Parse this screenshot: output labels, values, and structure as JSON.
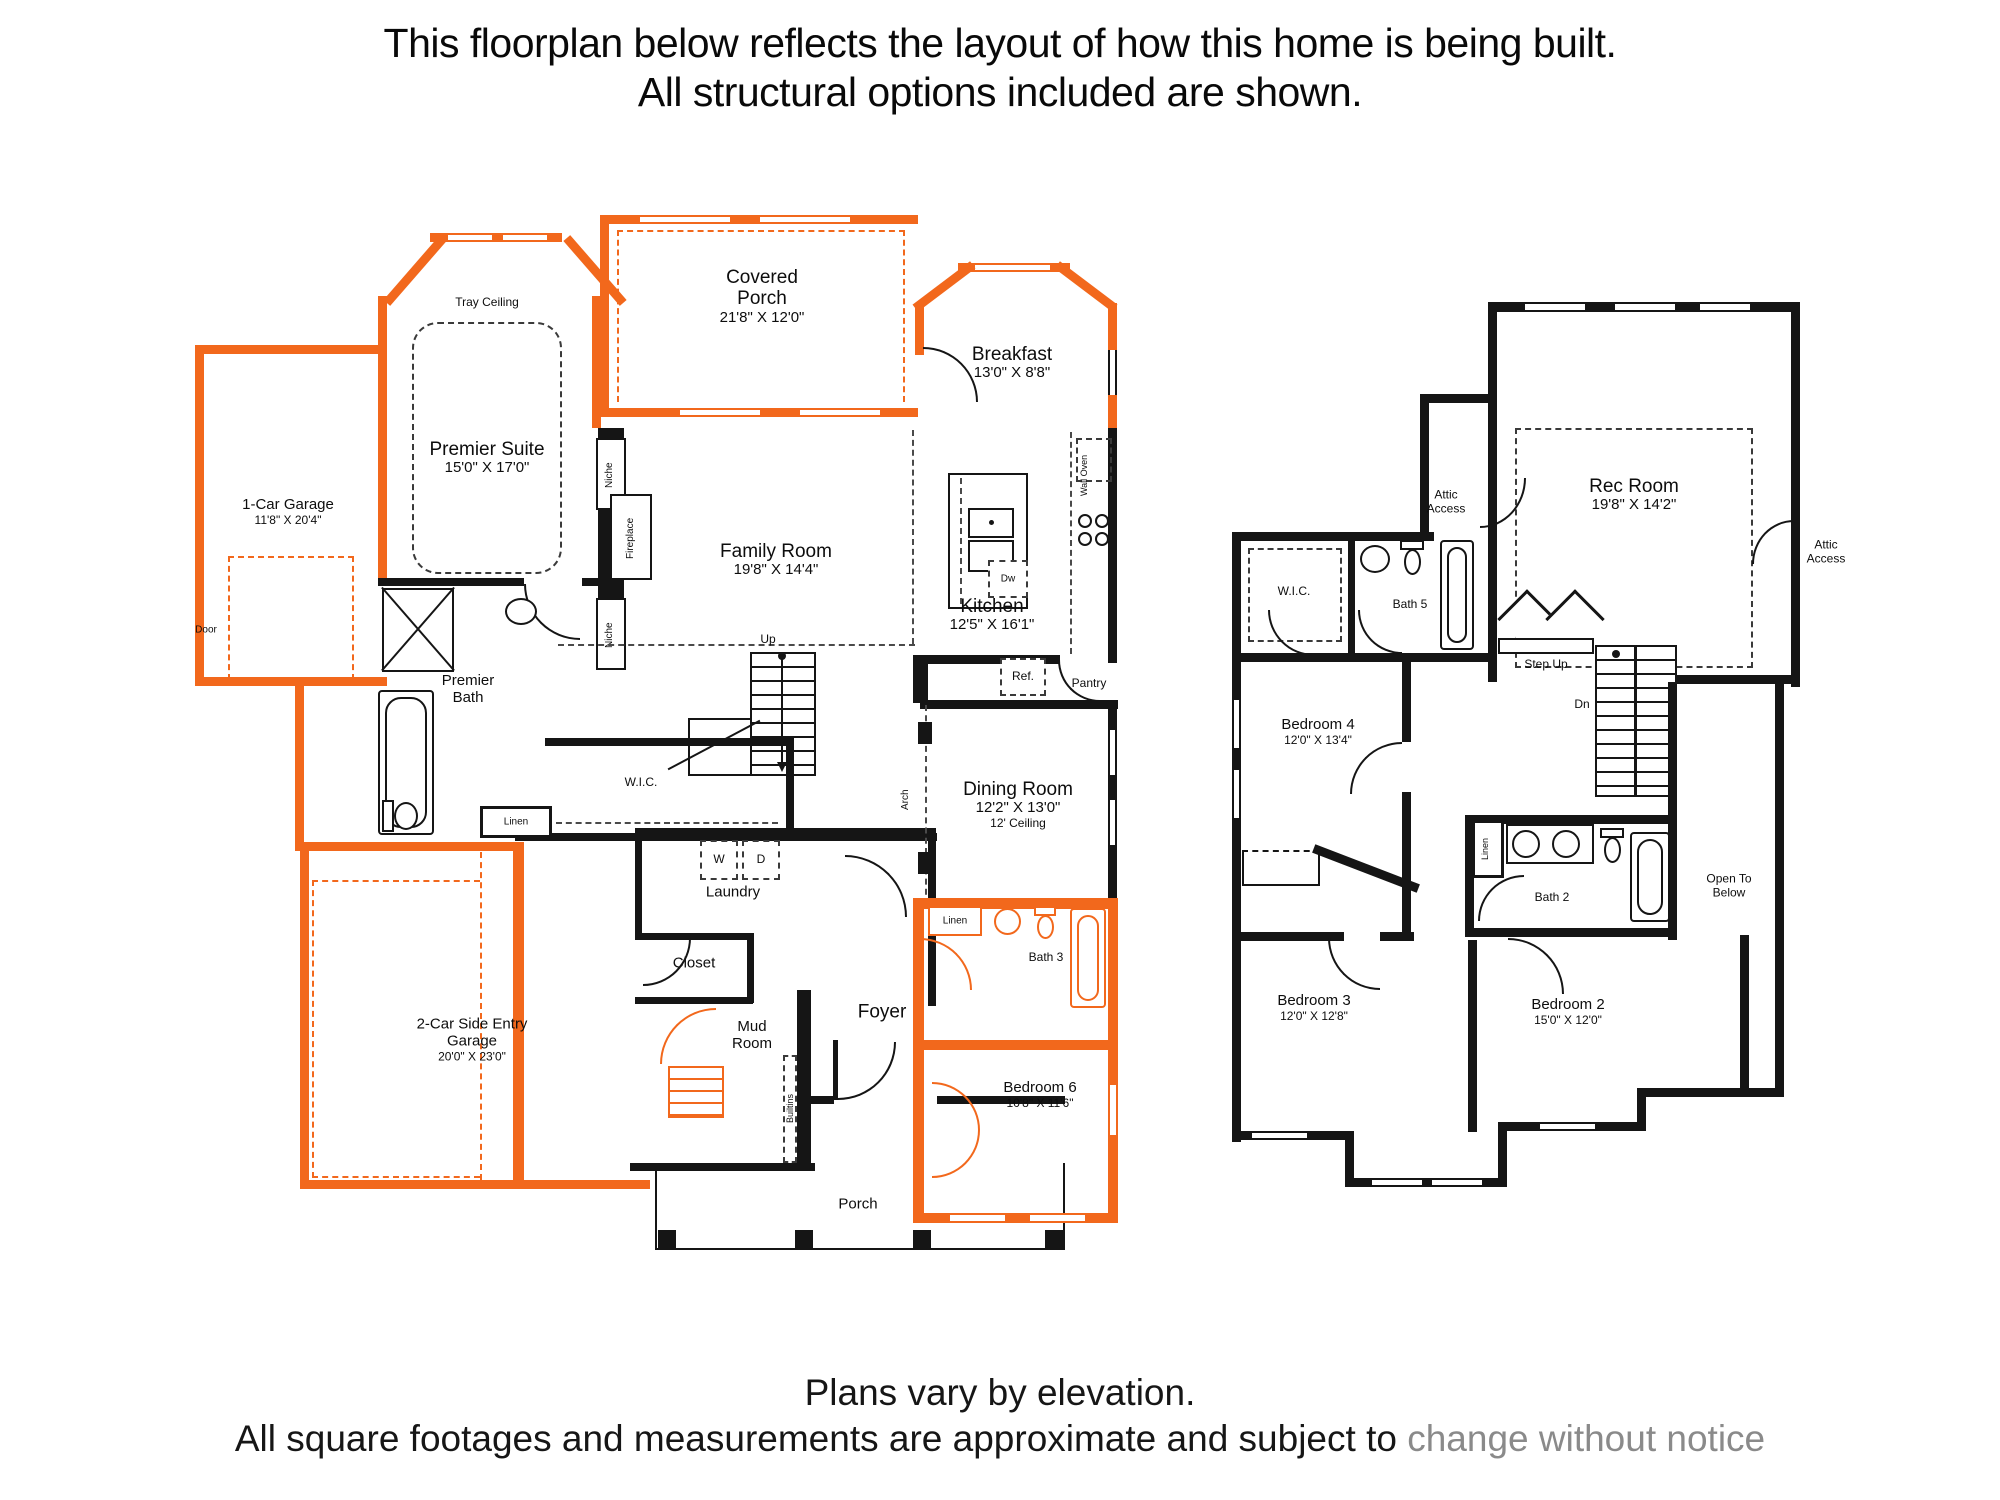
{
  "header": {
    "line1": "This floorplan below reflects the layout of how this home is being built.",
    "line2": "All structural options included are shown."
  },
  "footer": {
    "line1": "Plans vary by elevation.",
    "line2_main": "All square footages and measurements are approximate and subject to ",
    "line2_tail": "change without notice"
  },
  "colors": {
    "optional_orange": "#F2681C",
    "standard_black": "#151515"
  },
  "floor1": {
    "covered_porch": {
      "name": "Covered Porch",
      "dims": "21'8\" X 12'0\""
    },
    "tray_ceiling": "Tray Ceiling",
    "premier_suite": {
      "name": "Premier Suite",
      "dims": "15'0\" X 17'0\""
    },
    "garage_1car": {
      "name": "1-Car Garage",
      "dims": "11'8\" X 20'4\""
    },
    "door": "Door",
    "breakfast": {
      "name": "Breakfast",
      "dims": "13'0\" X 8'8\""
    },
    "family_room": {
      "name": "Family Room",
      "dims": "19'8\" X 14'4\""
    },
    "niche_top": "Niche",
    "fireplace": "Fireplace",
    "niche_bottom": "Niche",
    "wall_oven": "Wall Oven",
    "kitchen": {
      "name": "Kitchen",
      "dims": "12'5\" X 16'1\""
    },
    "dw": "Dw",
    "ref": "Ref.",
    "pantry": "Pantry",
    "up": "Up",
    "premier_bath": {
      "name": "Premier Bath"
    },
    "wic": "W.I.C.",
    "linen": "Linen",
    "laundry": "Laundry",
    "washer": "W",
    "dryer": "D",
    "dining_room": {
      "name": "Dining Room",
      "dims": "12'2\" X 13'0\"",
      "ceiling": "12' Ceiling"
    },
    "arch": "Arch",
    "closet": "Closet",
    "mud_room": {
      "name": "Mud Room"
    },
    "foyer": "Foyer",
    "builtins": "Builtins",
    "bath3": {
      "name": "Bath 3"
    },
    "linen2": "Linen",
    "bedroom6": {
      "name": "Bedroom 6",
      "dims": "10'8\" X 11'6\""
    },
    "porch": "Porch",
    "garage_2car": {
      "name": "2-Car Side Entry Garage",
      "dims": "20'0\" X 23'0\""
    }
  },
  "floor2": {
    "attic_access_left": "Attic Access",
    "rec_room": {
      "name": "Rec Room",
      "dims": "19'8\" X 14'2\""
    },
    "attic_access_right": "Attic Access",
    "wic": "W.I.C.",
    "bath5": {
      "name": "Bath 5"
    },
    "step_up": "Step Up",
    "bedroom4": {
      "name": "Bedroom 4",
      "dims": "12'0\" X 13'4\""
    },
    "dn": "Dn",
    "linen": "Linen",
    "bath2": {
      "name": "Bath 2"
    },
    "open_to_below": "Open To Below",
    "bedroom3": {
      "name": "Bedroom 3",
      "dims": "12'0\" X 12'8\""
    },
    "bedroom2": {
      "name": "Bedroom 2",
      "dims": "15'0\" X 12'0\""
    }
  }
}
